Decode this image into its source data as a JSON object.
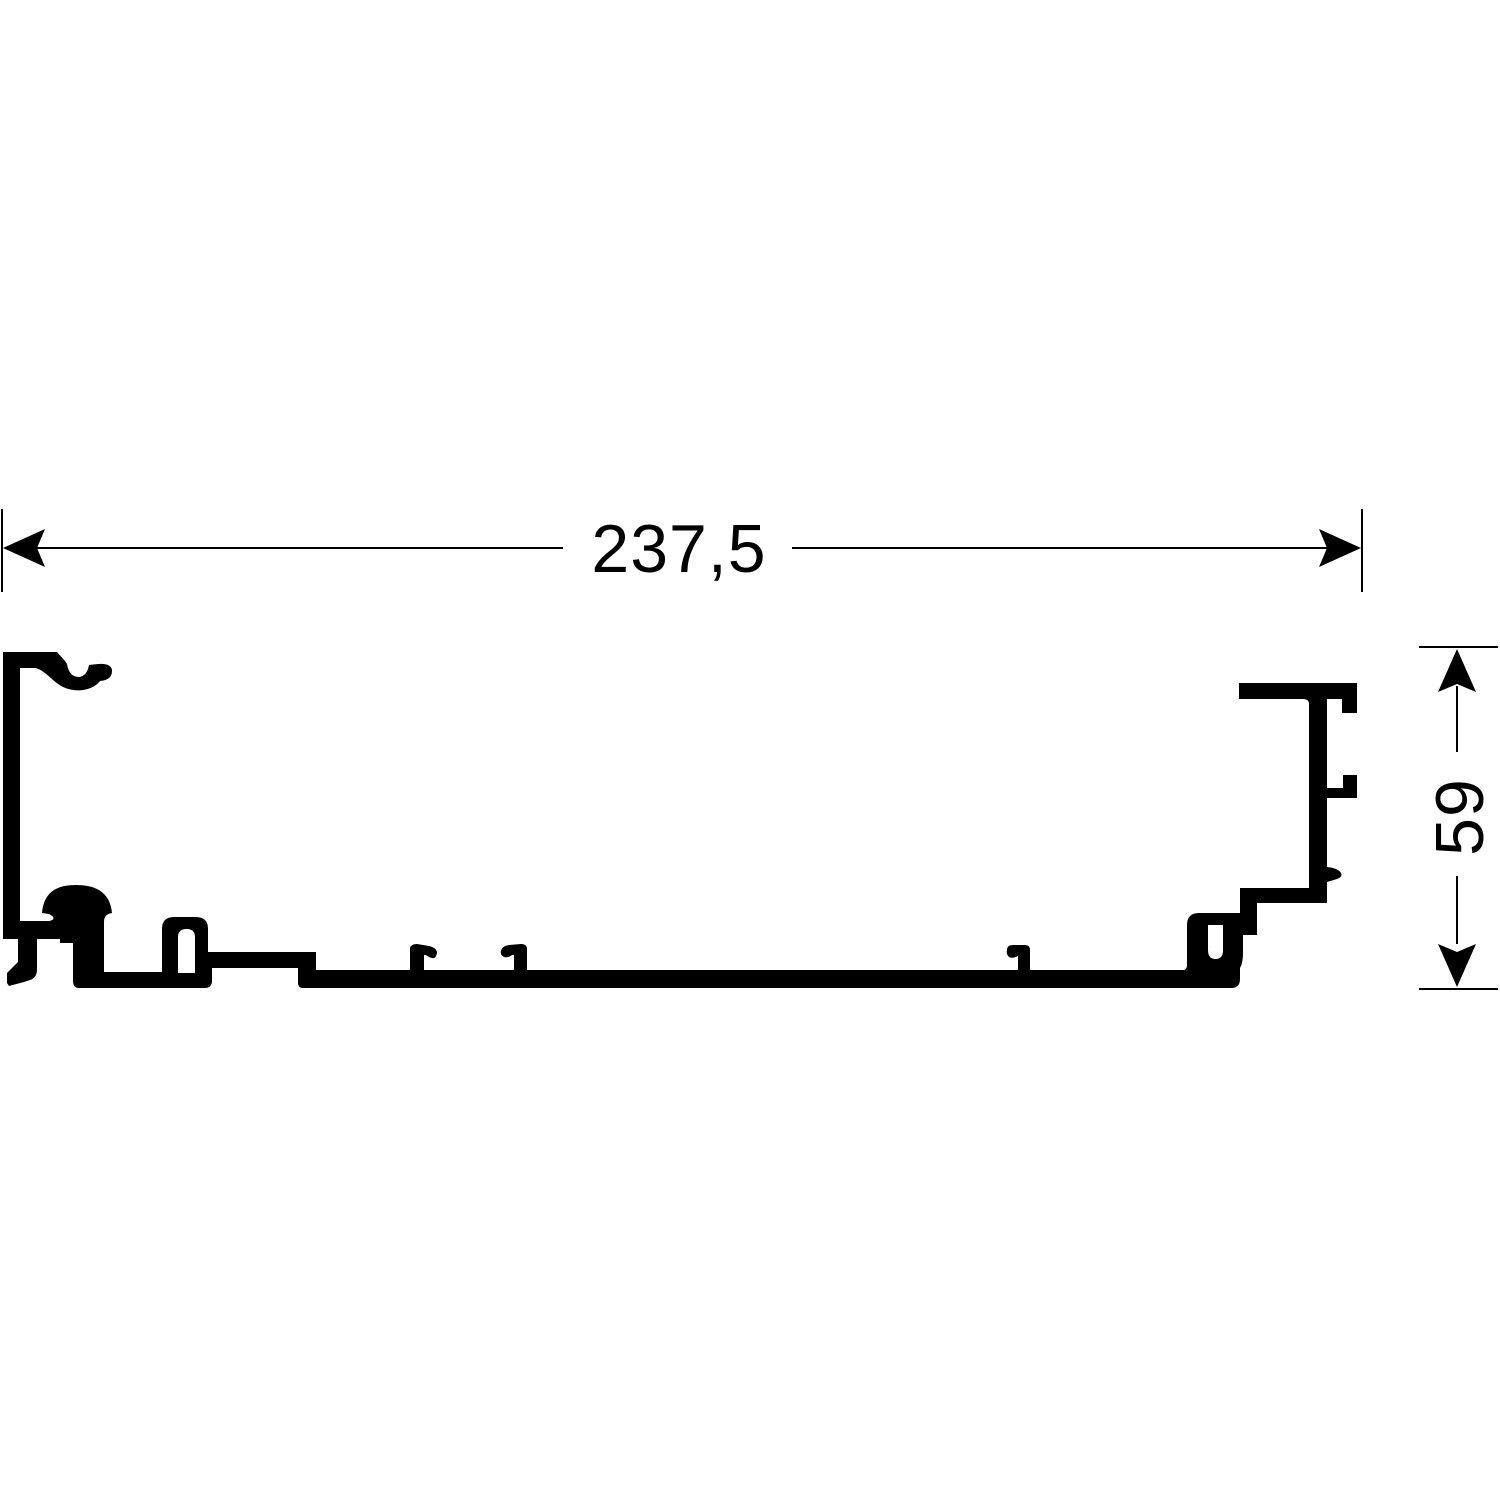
{
  "drawing": {
    "title": "profile-cross-section",
    "background_color": "#ffffff",
    "line_color": "#000000",
    "dimensions": {
      "width": {
        "label": "237,5",
        "orientation": "horizontal"
      },
      "height": {
        "label": "59",
        "orientation": "vertical"
      }
    }
  }
}
